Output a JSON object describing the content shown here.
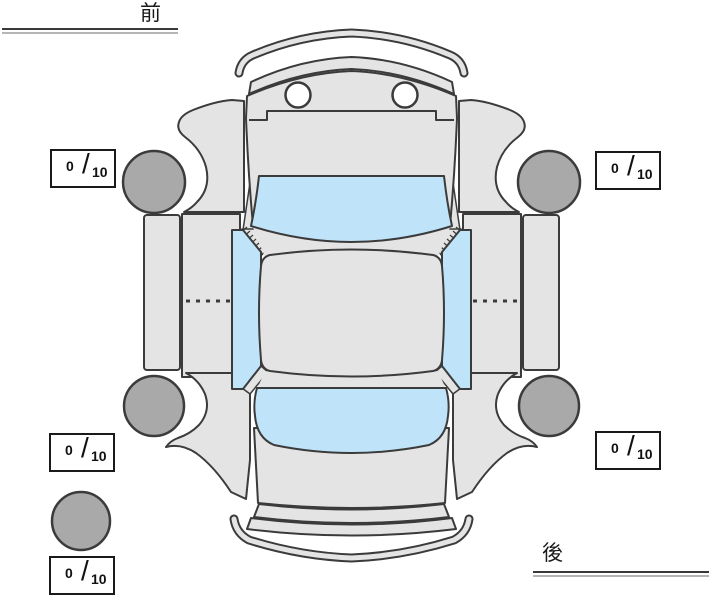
{
  "labels": {
    "front": "前",
    "rear": "後"
  },
  "ratings": {
    "slash": "/",
    "front_left": {
      "value": "0",
      "max": "10"
    },
    "front_right": {
      "value": "0",
      "max": "10"
    },
    "rear_left": {
      "value": "0",
      "max": "10"
    },
    "rear_right": {
      "value": "0",
      "max": "10"
    },
    "spare": {
      "value": "0",
      "max": "10"
    }
  },
  "diagram": {
    "type": "car-top-view-condition-map",
    "tires": [
      "front-left",
      "front-right",
      "rear-left",
      "rear-right",
      "spare"
    ]
  },
  "colors": {
    "body": "#e4e4e4",
    "glass": "#bfe3f8",
    "tire": "#a9a9a9",
    "outline": "#3b3b3b",
    "box_border": "#1a1a1a",
    "rule_dark": "#3a3a3a",
    "rule_light": "#b5b5b5"
  }
}
